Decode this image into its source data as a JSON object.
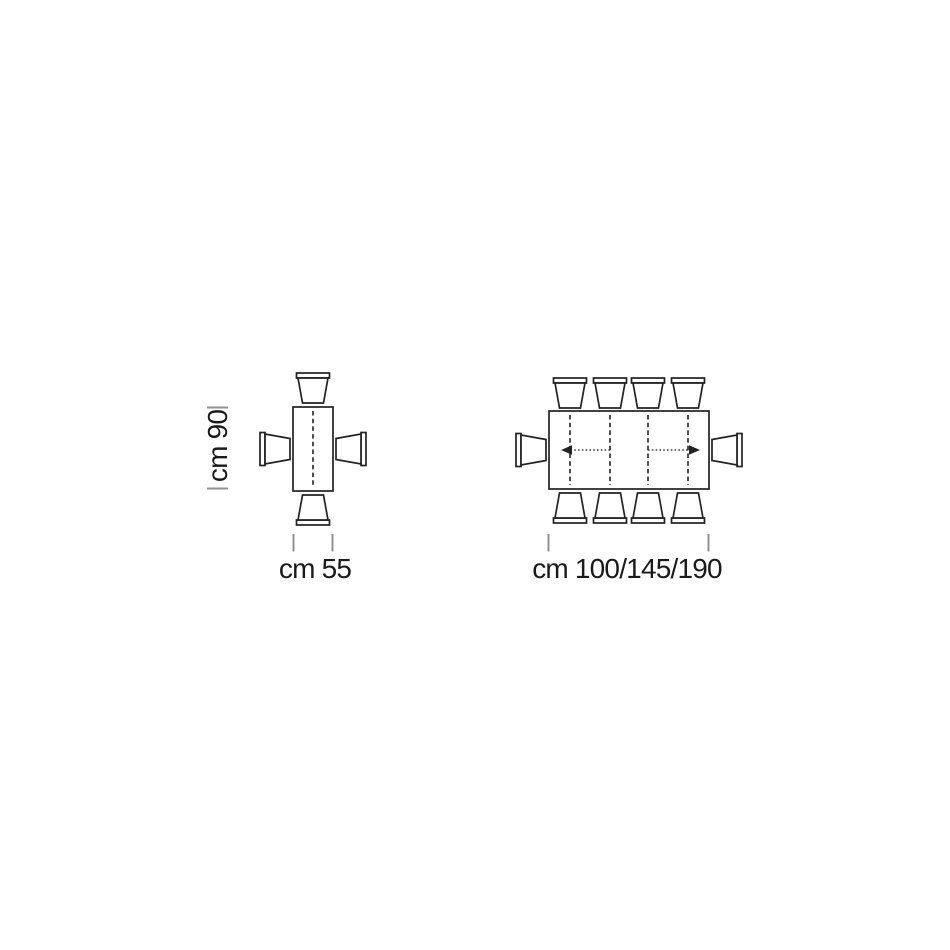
{
  "colors": {
    "line": "#222222",
    "tick": "#909090",
    "text": "#1a1a1a",
    "arrow": "#3d3d3d",
    "bg": "#ffffff"
  },
  "small_table": {
    "depth_label": "cm 90",
    "width_label": "cm 55",
    "chair_count": 4
  },
  "large_table": {
    "width_label": "cm 100/145/190",
    "chair_count": 10,
    "extension_leaf_lines": 4
  }
}
